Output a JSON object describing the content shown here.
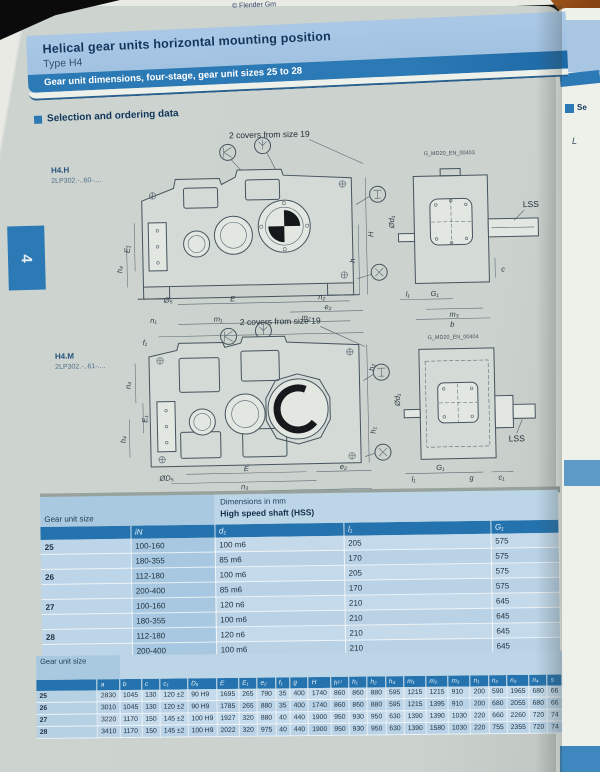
{
  "photo": {
    "copyright": "© Flender Gm"
  },
  "next_page": {
    "snippet_1": "Se",
    "snippet_2": "L"
  },
  "page": {
    "chapter_tab": "4",
    "title": "Helical gear units horizontal mounting position",
    "subtitle": "Type H4",
    "band": "Gear unit dimensions, four-stage, gear unit sizes 25 to 28",
    "section": "Selection and ordering data"
  },
  "drawings": {
    "h4h": {
      "model": "H4.H",
      "code": "2LP302.-..60-....",
      "note": "2 covers from size 19",
      "doc_id": "G_MD20_EN_00403",
      "lss": "LSS",
      "dims": [
        "E₁",
        "h₄",
        "n₁",
        "f₁",
        "Ø₅",
        "E",
        "n₂",
        "e₂",
        "m₁",
        "m₂",
        "a",
        "H",
        "h",
        "Ød₁",
        "l₁",
        "G₁",
        "m₃",
        "b",
        "c"
      ]
    },
    "h4m": {
      "model": "H4.M",
      "code": "2LP302.-..61-....",
      "note": "2 covers from size 19",
      "doc_id": "G_MD20_EN_00404",
      "lss": "LSS",
      "dims": [
        "n₄",
        "E₁",
        "h₄",
        "ØD₅",
        "E",
        "n₃",
        "a",
        "e₂",
        "h₂",
        "h₁",
        "Ød₁",
        "l₁",
        "G₁",
        "g",
        "c₁"
      ]
    }
  },
  "hss_table": {
    "corner": "Gear unit size",
    "note": "Dimensions in mm",
    "subtitle": "High speed shaft (HSS)",
    "cols": [
      "",
      "iN",
      "d₁",
      "l₁",
      "G₁"
    ],
    "rows": [
      [
        "25",
        "100-160",
        "100 m6",
        "205",
        "575"
      ],
      [
        "",
        "180-355",
        "85 m6",
        "170",
        "575"
      ],
      [
        "26",
        "112-180",
        "100 m6",
        "205",
        "575"
      ],
      [
        "",
        "200-400",
        "85 m6",
        "170",
        "575"
      ],
      [
        "27",
        "100-160",
        "120 n6",
        "210",
        "645"
      ],
      [
        "",
        "180-355",
        "100 m6",
        "210",
        "645"
      ],
      [
        "28",
        "112-180",
        "120 n6",
        "210",
        "645"
      ],
      [
        "",
        "200-400",
        "100 m6",
        "210",
        "645"
      ]
    ]
  },
  "dim_table": {
    "corner": "Gear unit size",
    "cols": [
      "",
      "a",
      "b",
      "c",
      "c₁",
      "D₅",
      "E",
      "E₁",
      "e₂",
      "f₁",
      "g",
      "H",
      "h¹⁾",
      "h₁",
      "h₂",
      "h₄",
      "m₁",
      "m₂",
      "m₃",
      "n₁",
      "n₂",
      "n₃",
      "n₄",
      "s"
    ],
    "rows": [
      [
        "25",
        "2830",
        "1045",
        "130",
        "120 ±2",
        "90 H9",
        "1695",
        "265",
        "790",
        "35",
        "400",
        "1740",
        "860",
        "860",
        "880",
        "595",
        "1215",
        "1215",
        "910",
        "200",
        "590",
        "1965",
        "680",
        "66"
      ],
      [
        "26",
        "3010",
        "1045",
        "130",
        "120 ±2",
        "90 H9",
        "1785",
        "265",
        "880",
        "35",
        "400",
        "1740",
        "860",
        "860",
        "880",
        "595",
        "1215",
        "1395",
        "910",
        "200",
        "680",
        "2055",
        "680",
        "66"
      ],
      [
        "27",
        "3220",
        "1170",
        "150",
        "145 ±2",
        "100 H9",
        "1927",
        "320",
        "880",
        "40",
        "440",
        "1900",
        "950",
        "930",
        "950",
        "630",
        "1390",
        "1390",
        "1030",
        "220",
        "660",
        "2260",
        "720",
        "74"
      ],
      [
        "28",
        "3410",
        "1170",
        "150",
        "145 ±2",
        "100 H9",
        "2022",
        "320",
        "975",
        "40",
        "440",
        "1900",
        "950",
        "930",
        "950",
        "630",
        "1390",
        "1580",
        "1030",
        "220",
        "755",
        "2355",
        "720",
        "74"
      ]
    ]
  }
}
